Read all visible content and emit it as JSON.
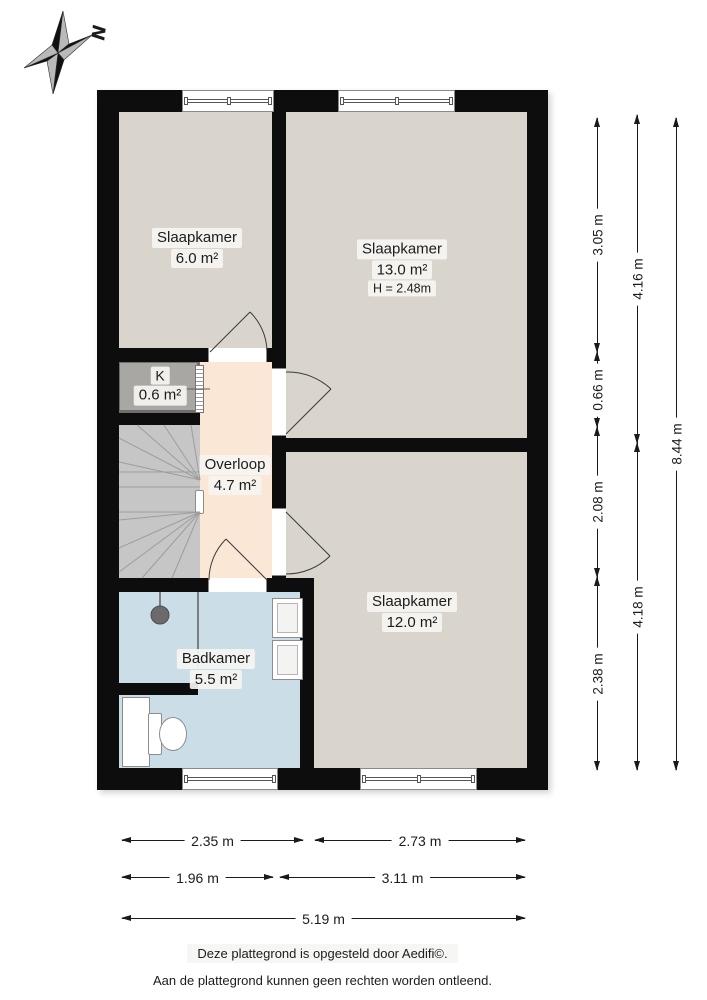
{
  "compass": {
    "label": "N"
  },
  "rooms": [
    {
      "name": "Slaapkamer",
      "area": "6.0 m²"
    },
    {
      "name": "Slaapkamer",
      "area": "13.0 m²",
      "ceiling_height": "H = 2.48m"
    },
    {
      "name": "K",
      "area": "0.6 m²"
    },
    {
      "name": "Overloop",
      "area": "4.7 m²"
    },
    {
      "name": "Badkamer",
      "area": "5.5 m²"
    },
    {
      "name": "Slaapkamer",
      "area": "12.0 m²"
    }
  ],
  "dimensions": {
    "right_inner": [
      "3.05 m",
      "0.66 m",
      "2.08 m",
      "2.38 m"
    ],
    "right_middle": [
      "4.16 m",
      "4.18 m"
    ],
    "right_outer": [
      "8.44 m"
    ],
    "bottom_row1": [
      "2.35 m",
      "2.73 m"
    ],
    "bottom_row2": [
      "1.96 m",
      "3.11 m"
    ],
    "bottom_total": [
      "5.19 m"
    ]
  },
  "footer": {
    "line1": "Deze plattegrond is opgesteld door Aedifi©.",
    "line2": "Aan de plattegrond kunnen geen rechten worden ontleend."
  },
  "colors": {
    "wall": "#0d0d0d",
    "room_fill": "#d9d4cc",
    "hallway_fill": "#fbe7d6",
    "bathroom_fill": "#cbdde7",
    "stairs_fill": "#c6c6c6",
    "closet_fill": "#a9a7a4",
    "closet_border": "#6e6e6e"
  }
}
